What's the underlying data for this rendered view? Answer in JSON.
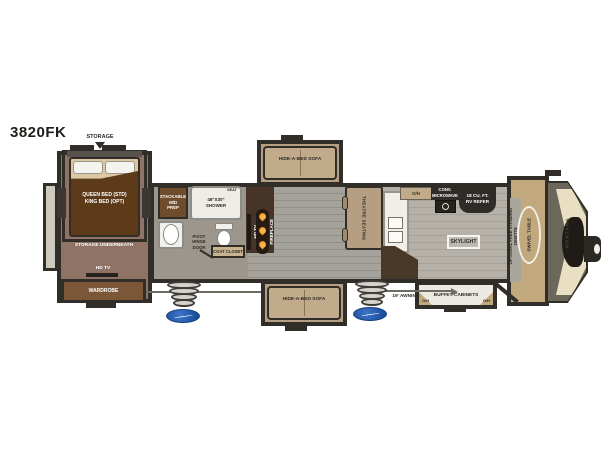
{
  "title": "3820FK",
  "colors": {
    "wall": "#312e2a",
    "bedroom_floor": "#8f7365",
    "living_floor": "#a5a29b",
    "kitchen_floor": "#b5b1a8",
    "slide_tan": "#b59e82",
    "bedspread_brown": "#5d3a18",
    "cabinet_brown": "#7b5737",
    "appliance_dark": "#2f2b27",
    "platform_tan": "#c2a87d",
    "front_cap_olive": "#6b675a",
    "front_cap_cream": "#e9dfc2",
    "step_logo_blue": "#2a62b5",
    "flame_orange": "#e8821e"
  },
  "exterior": {
    "storage_hatch_label": "STORAGE",
    "awning_label": "19' AWNING",
    "front_cap_brand": "MONTANA"
  },
  "bedroom": {
    "bed_label": "QUEEN BED (STD)\nKING BED (OPT)",
    "under_bed_label": "STORAGE UNDERNEATH",
    "tv_label": "HD TV",
    "wardrobe_label": "WARDROBE"
  },
  "bathroom": {
    "washer_dryer_label": "STACKABLE\nW/D\nPREP",
    "shower_label": "48\"X30\"\nSHOWER",
    "shower_seat_label": "SEAT",
    "pivot_door_label": "PIVOT\nHINGE\nDOOR",
    "coat_closet_label": "COAT CLOSET"
  },
  "living_room": {
    "tv_label": "HD TV",
    "fireplace_label": "FIREPLACE",
    "sofa_top_label": "HIDE-A-BED SOFA",
    "sofa_bottom_label": "HIDE-A-BED SOFA",
    "theatre_label": "THEATRE SEATING"
  },
  "kitchen": {
    "overhead_label": "O/H",
    "microwave_label": "CONV.\nMICROWAVE",
    "refrigerator_label": "18 CU. FT.\nRV REFER",
    "skylight_label": "SKYLIGHT"
  },
  "front_area": {
    "dinette_label": "OPTIONAL\nFREE STANDING\nDINETTE",
    "swivel_table_label": "SWIVEL TABLE",
    "buffet_label": "BUFFET CABINETS",
    "buffet_oh_left": "O/H",
    "buffet_oh_right": "O/H"
  }
}
